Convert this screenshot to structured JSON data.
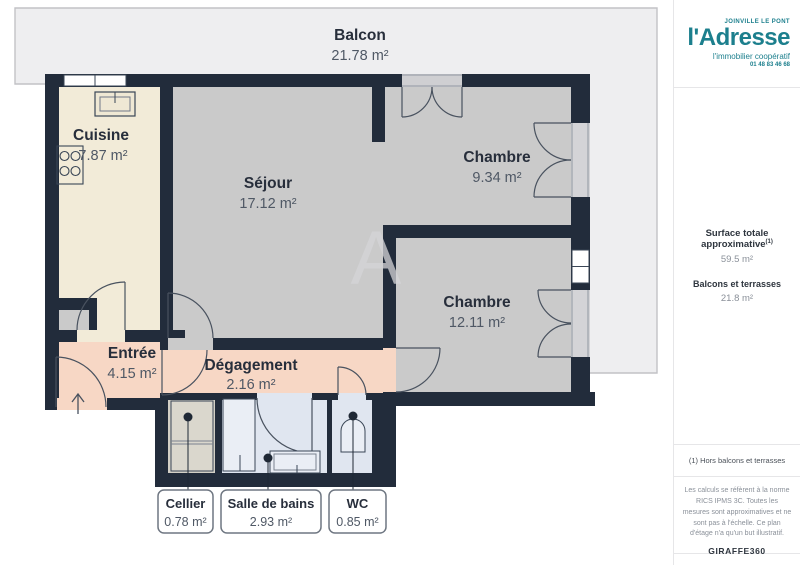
{
  "plan": {
    "watermark": "A",
    "rooms": [
      {
        "name": "Balcon",
        "area": "21.78 m²"
      },
      {
        "name": "Cuisine",
        "area": "7.87 m²"
      },
      {
        "name": "Séjour",
        "area": "17.12 m²"
      },
      {
        "name": "Chambre",
        "area": "9.34 m²"
      },
      {
        "name": "Chambre",
        "area": "12.11 m²"
      },
      {
        "name": "Entrée",
        "area": "4.15 m²"
      },
      {
        "name": "Dégagement",
        "area": "2.16 m²"
      }
    ],
    "callouts": [
      {
        "name": "Cellier",
        "area": "0.78 m²"
      },
      {
        "name": "Salle de bains",
        "area": "2.93 m²"
      },
      {
        "name": "WC",
        "area": "0.85 m²"
      }
    ]
  },
  "sidebar": {
    "logo": {
      "city": "JOINVILLE LE PONT",
      "brand": "l'Adresse",
      "tagline": "l'immobilier coopératif",
      "phone": "01 48 83 46 68"
    },
    "surface_title": "Surface totale approximative",
    "surface_sup": "(1)",
    "surface_value": "59.5 m²",
    "balcony_title": "Balcons et terrasses",
    "balcony_value": "21.8 m²",
    "footnote": "(1) Hors balcons et terrasses",
    "legal": "Les calculs se réfèrent à la norme RICS IPMS 3C. Toutes les mesures sont approximatives et ne sont pas à l'échelle. Ce plan d'étage n'a qu'un but illustratif.",
    "brand_footer_bold": "GIRAFFE",
    "brand_footer_light": "360"
  },
  "colors": {
    "brand_teal": "#1C7F8D",
    "wall": "#222C3B",
    "floor_gray": "#CACACA",
    "floor_cream": "#F2EBD8",
    "floor_salmon": "#F7D7C5",
    "floor_blue": "#E0E6F0",
    "floor_taupe": "#D3D0C6",
    "balcony": "#EEEEF0"
  }
}
